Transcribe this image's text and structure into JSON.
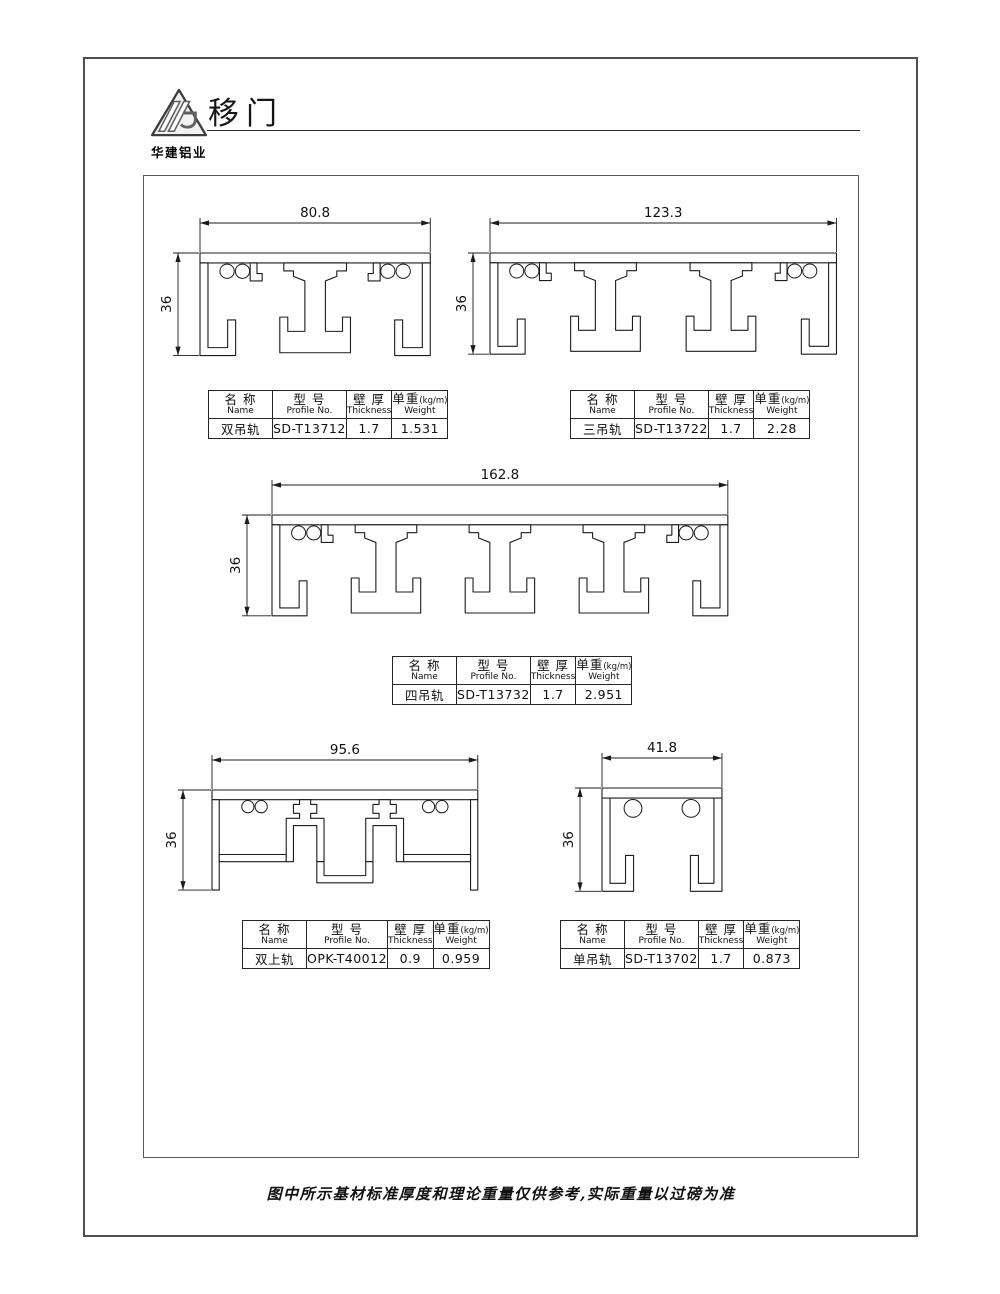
{
  "page": {
    "title": "移门",
    "logo_text": "华建铝业",
    "footer_note": "图中所示基材标准厚度和理论重量仅供参考,实际重量以过磅为准"
  },
  "table_headers": {
    "name_cn": "名 称",
    "name_en": "Name",
    "model_cn": "型 号",
    "model_en": "Profile No.",
    "thick_cn": "壁 厚",
    "thick_en": "Thickness",
    "weight_cn": "单重",
    "weight_unit": "(kg/m)",
    "weight_en": "Weight"
  },
  "profiles": [
    {
      "name": "双吊轨",
      "model": "SD-T13712",
      "thickness": "1.7",
      "weight": "1.531",
      "width_dim": "80.8",
      "height_dim": "36"
    },
    {
      "name": "三吊轨",
      "model": "SD-T13722",
      "thickness": "1.7",
      "weight": "2.28",
      "width_dim": "123.3",
      "height_dim": "36"
    },
    {
      "name": "四吊轨",
      "model": "SD-T13732",
      "thickness": "1.7",
      "weight": "2.951",
      "width_dim": "162.8",
      "height_dim": "36"
    },
    {
      "name": "双上轨",
      "model": "OPK-T40012",
      "thickness": "0.9",
      "weight": "0.959",
      "width_dim": "95.6",
      "height_dim": "36"
    },
    {
      "name": "单吊轨",
      "model": "SD-T13702",
      "thickness": "1.7",
      "weight": "0.873",
      "width_dim": "41.8",
      "height_dim": "36"
    }
  ]
}
